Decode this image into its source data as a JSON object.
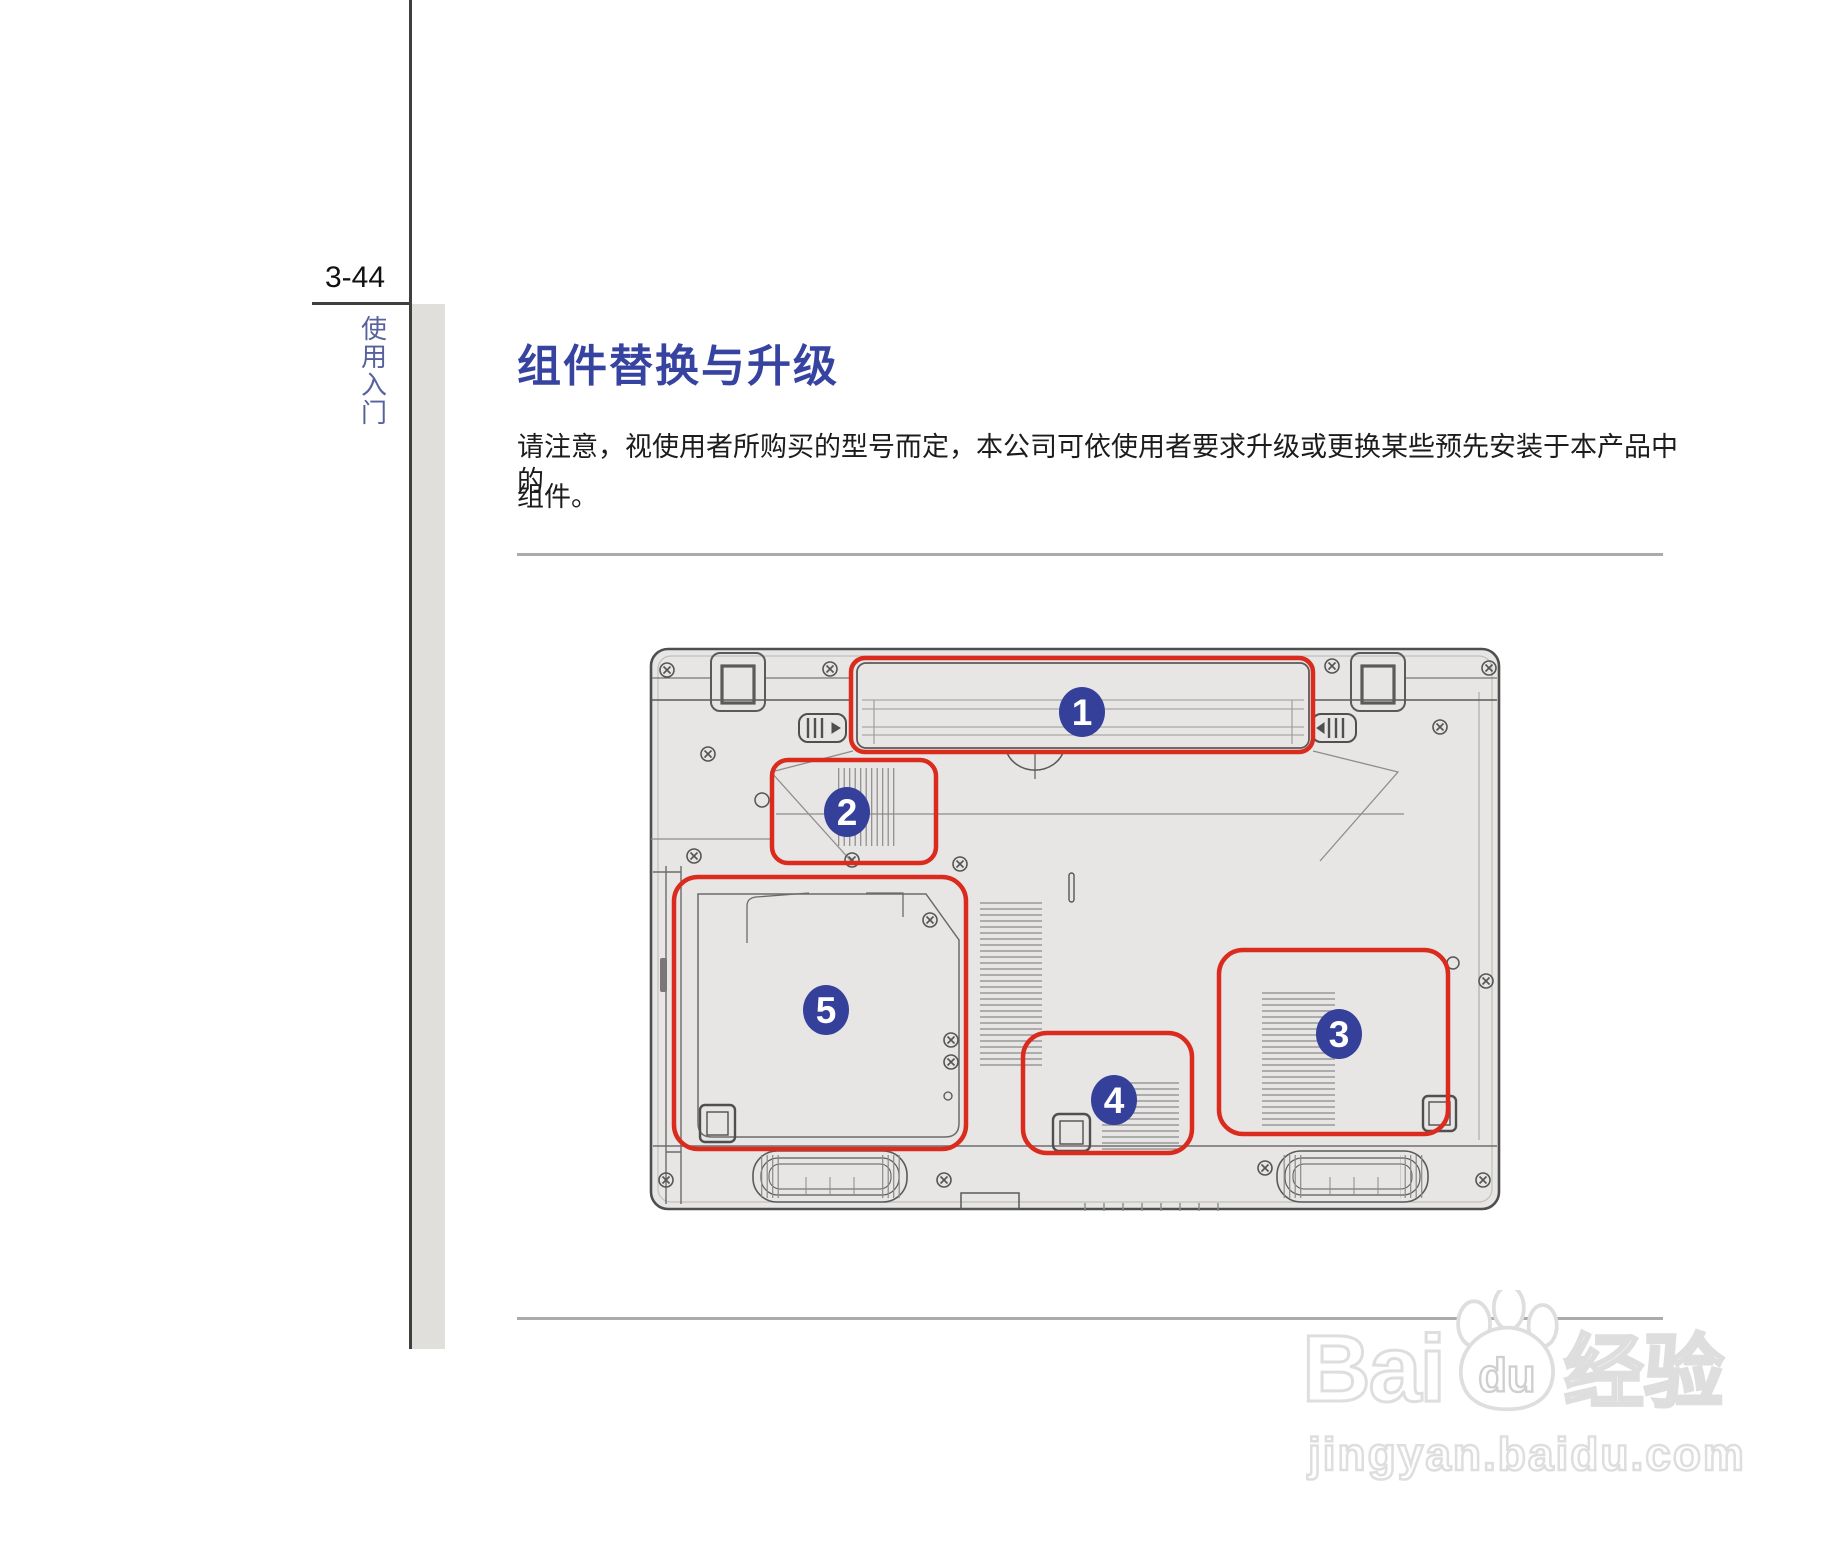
{
  "page": {
    "number": "3-44",
    "section_vertical_label": "使用入门",
    "title": "组件替换与升级",
    "paragraph_line1": "请注意，视使用者所购买的型号而定，本公司可依使用者要求升级或更换某些预先安装于本产品中的",
    "paragraph_line2": "组件。"
  },
  "diagram": {
    "subject": "laptop-bottom-view",
    "callouts": [
      {
        "number": "1"
      },
      {
        "number": "2"
      },
      {
        "number": "3"
      },
      {
        "number": "4"
      },
      {
        "number": "5"
      }
    ],
    "colors": {
      "highlight": "#db2b1e",
      "callout_bg": "#35409b",
      "callout_text": "#ffffff",
      "laptop_fill": "#e7e6e4",
      "outline": "#4f4f4f"
    }
  },
  "watermark": {
    "logo_bai": "Bai",
    "logo_du": "du",
    "logo_cn": "经验",
    "url": "jingyan.baidu.com"
  }
}
